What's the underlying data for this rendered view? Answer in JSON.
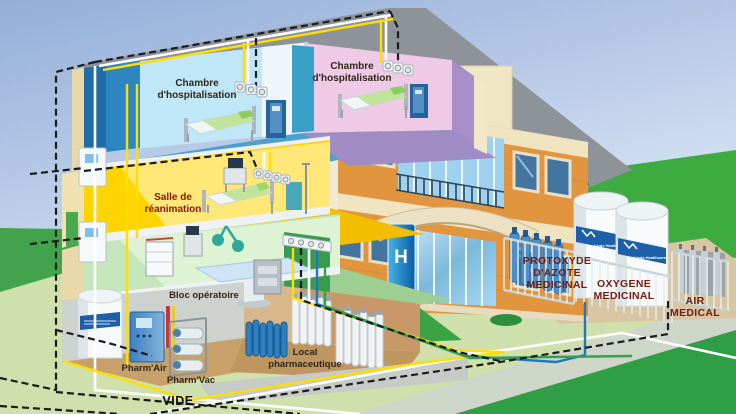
{
  "scene": {
    "description": "Isometric cutaway illustration of a hospital medical gas distribution system"
  },
  "labels": {
    "room_hosp_left": {
      "line1": "Chambre",
      "line2": "d'hospitalisation"
    },
    "room_hosp_right": {
      "line1": "Chambre",
      "line2": "d'hospitalisation"
    },
    "room_reanimation": {
      "line1": "Salle de",
      "line2": "réanimation"
    },
    "room_operating": "Bloc opératoire",
    "pharm_air": "Pharm'Air",
    "pharm_vac": "Pharm'Vac",
    "local_pharma": {
      "line1": "Local",
      "line2": "pharmaceutique"
    },
    "vacuum_network": "VIDE",
    "nitrous_tank": {
      "line1": "PROTOXYDE",
      "line2": "D'AZOTE",
      "line3": "MEDICINAL"
    },
    "oxygen_tank": {
      "line1": "OXYGENE",
      "line2": "MEDICINAL"
    },
    "air_tank": {
      "line1": "AIR",
      "line2": "MEDICAL"
    },
    "hospital_sign": "H",
    "tank_brand": "Linde Healthcare"
  },
  "colors": {
    "pipe_vacuum": "#1c1c1c",
    "pipe_white": "#ffffff",
    "pipe_yellow": "#ffdf00",
    "pipe_blue": "#2277bb",
    "pipe_green": "#33a04a",
    "roof": "#8d9398",
    "roof_edge": "#176084",
    "brick": "#e2953f",
    "cream": "#f0e3c0",
    "room_blue_wall": "#bfe7f7",
    "room_pink_wall": "#eecae6",
    "room_purple_wall": "#a98fc9",
    "room_yellow_wall": "#ffd400",
    "room_green_wall": "#c4e6ba",
    "basement_floor": "#c8a06a",
    "tank_band_blue": "#1d5fa8",
    "sign_blue": "#0f7fc0",
    "grass_dark": "#2f9e44",
    "grass_light": "#cfe0ad",
    "sky_top": "#93aed8",
    "sky_bottom": "#d6e3f3"
  }
}
